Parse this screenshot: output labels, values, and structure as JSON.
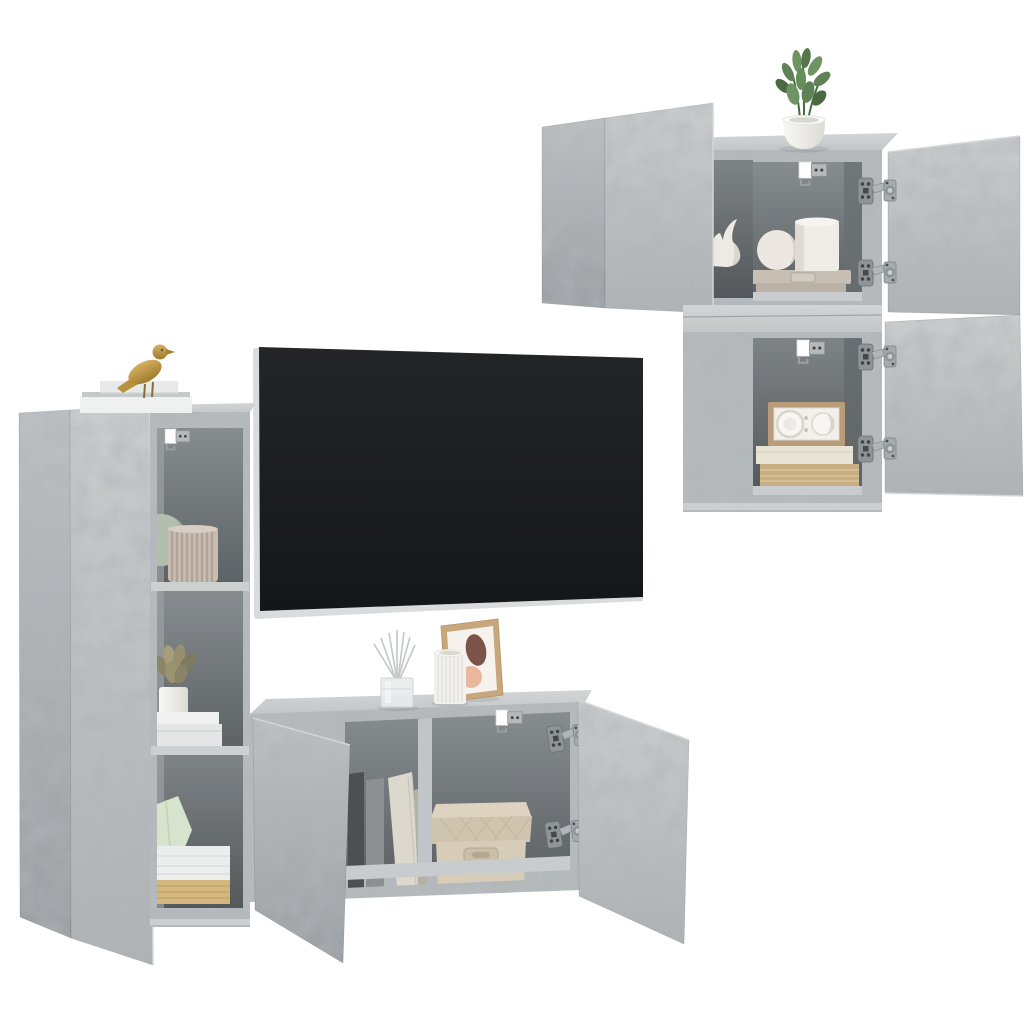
{
  "scene": {
    "caption": "Product photo: 4-piece concrete-grey wall-mounted TV wall unit set with open doors, flat-screen TV and decor on a white background",
    "background_color": "#ffffff",
    "material": "concrete grey engineered wood",
    "units": [
      {
        "label": "tall wall cabinet with open door and three open shelves",
        "position": "left"
      },
      {
        "label": "upper square wall cabinet with two open doors",
        "position": "top-right"
      },
      {
        "label": "lower square wall cabinet with open door",
        "position": "right"
      },
      {
        "label": "low horizontal wall cabinet with two open doors",
        "position": "bottom-center"
      }
    ],
    "tv": {
      "label": "wall-mounted flat screen TV",
      "screen_color": "#1c1d1f",
      "edge_color": "#d9dbdc"
    },
    "decor": [
      {
        "label": "gold bird figurine on book stack",
        "color": "#c9a254"
      },
      {
        "label": "white book stack on tall cabinet",
        "color": "#eff1f1"
      },
      {
        "label": "sage round vase",
        "color": "#b3bfae"
      },
      {
        "label": "beige pleated vase",
        "color": "#c9bdb2"
      },
      {
        "label": "succulent in white pot on books",
        "color": "#96906f"
      },
      {
        "label": "pale green geometric ornament",
        "color": "#d6e3cd"
      },
      {
        "label": "white books with gilded pages",
        "color": "#d4b77e"
      },
      {
        "label": "potted green plant on upper cabinet",
        "color": "#5e8256"
      },
      {
        "label": "white rhino head figurine",
        "color": "#edeae5"
      },
      {
        "label": "white sphere vase and cylinder pot on grey keepsake box",
        "color": "#c7bfb3"
      },
      {
        "label": "retro radio on stacked books",
        "color": "#b99c79"
      },
      {
        "label": "reed diffuser in glass cube",
        "color": "#e8ecec"
      },
      {
        "label": "white fluted vase",
        "color": "#f2f1ed"
      },
      {
        "label": "framed abstract art print",
        "color": "#c8a77c"
      },
      {
        "label": "grey and cream books inside low cabinet",
        "color": "#8e8f91"
      },
      {
        "label": "beige quilted storage box",
        "color": "#d5cab6"
      }
    ],
    "hardware": [
      {
        "label": "soft-close door hinges",
        "color": "#a9aeb1"
      },
      {
        "label": "wall-mount brackets",
        "color": "#b4b9bc"
      }
    ]
  },
  "palette": {
    "bg": "#ffffff",
    "concrete": "#b6babc",
    "concreteLight": "#c7cacb",
    "concreteDark": "#a0a4a6",
    "edgeLight": "#d6d8d9",
    "topSurface": "#ced1d2",
    "interiorBack": "#84898c",
    "interiorBackDeep": "#5b6063",
    "interiorSide": "#9da1a4",
    "shelf": "#cdd0d1",
    "floorLight": "#c9ccce",
    "tvBlack": "#1c1d1f",
    "tvEdge": "#d9dbdc",
    "metal": "#a9aeb1",
    "metalDark": "#52575a",
    "white": "#f4f4f2",
    "sage": "#b3bfae",
    "beigeVase": "#c9bdb2",
    "gold": "#c9a254",
    "green": "#5e8256",
    "greenDark": "#486b40",
    "cream": "#e9e3d6",
    "tanBook": "#c9ae84",
    "boxBeige": "#d5cab6",
    "radioTan": "#b99c79",
    "artPeach": "#e9b79c",
    "artBrown": "#7b5349",
    "paleGreen": "#d6e3cd",
    "pageGold": "#d4b77e",
    "bookDark": "#4e4f51",
    "bookGray": "#8e8f91"
  }
}
